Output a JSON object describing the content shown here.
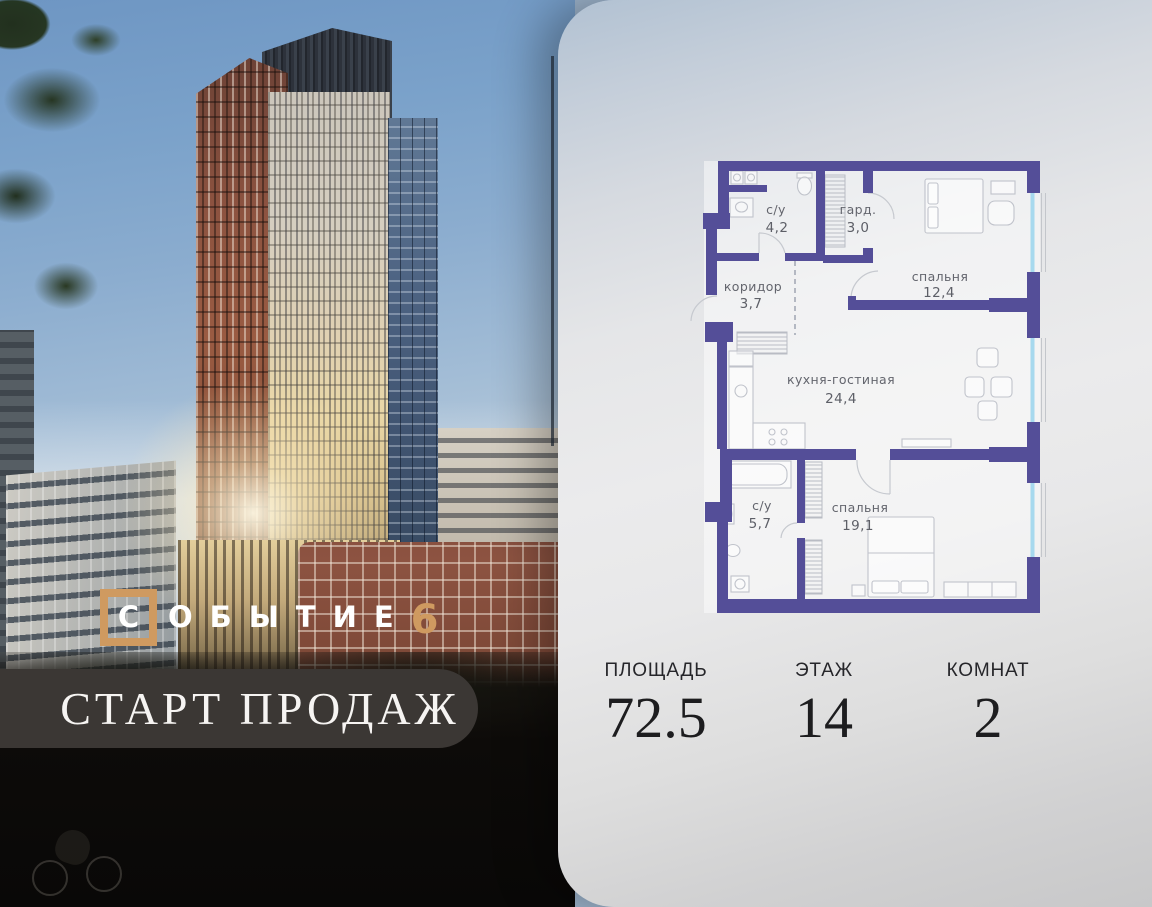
{
  "logo": {
    "boxed_letter": "С",
    "word_rest": "ОБЫТИЕ",
    "suffix_number": "6",
    "accent_color": "#cf9a60"
  },
  "banner": {
    "text": "СТАРТ ПРОДАЖ"
  },
  "plan": {
    "wall_color": "#544e98",
    "window_color": "#a7d9ee",
    "label_color": "#63656d",
    "rooms": [
      {
        "name": "с/у",
        "area": "4,2"
      },
      {
        "name": "гард.",
        "area": "3,0"
      },
      {
        "name": "коридор",
        "area": "3,7"
      },
      {
        "name": "спальня",
        "area": "12,4"
      },
      {
        "name": "кухня-гостиная",
        "area": "24,4"
      },
      {
        "name": "с/у",
        "area": "5,7"
      },
      {
        "name": "спальня",
        "area": "19,1"
      }
    ]
  },
  "stats": [
    {
      "label": "ПЛОЩАДЬ",
      "value": "72.5"
    },
    {
      "label": "ЭТАЖ",
      "value": "14"
    },
    {
      "label": "КОМНАТ",
      "value": "2"
    }
  ]
}
